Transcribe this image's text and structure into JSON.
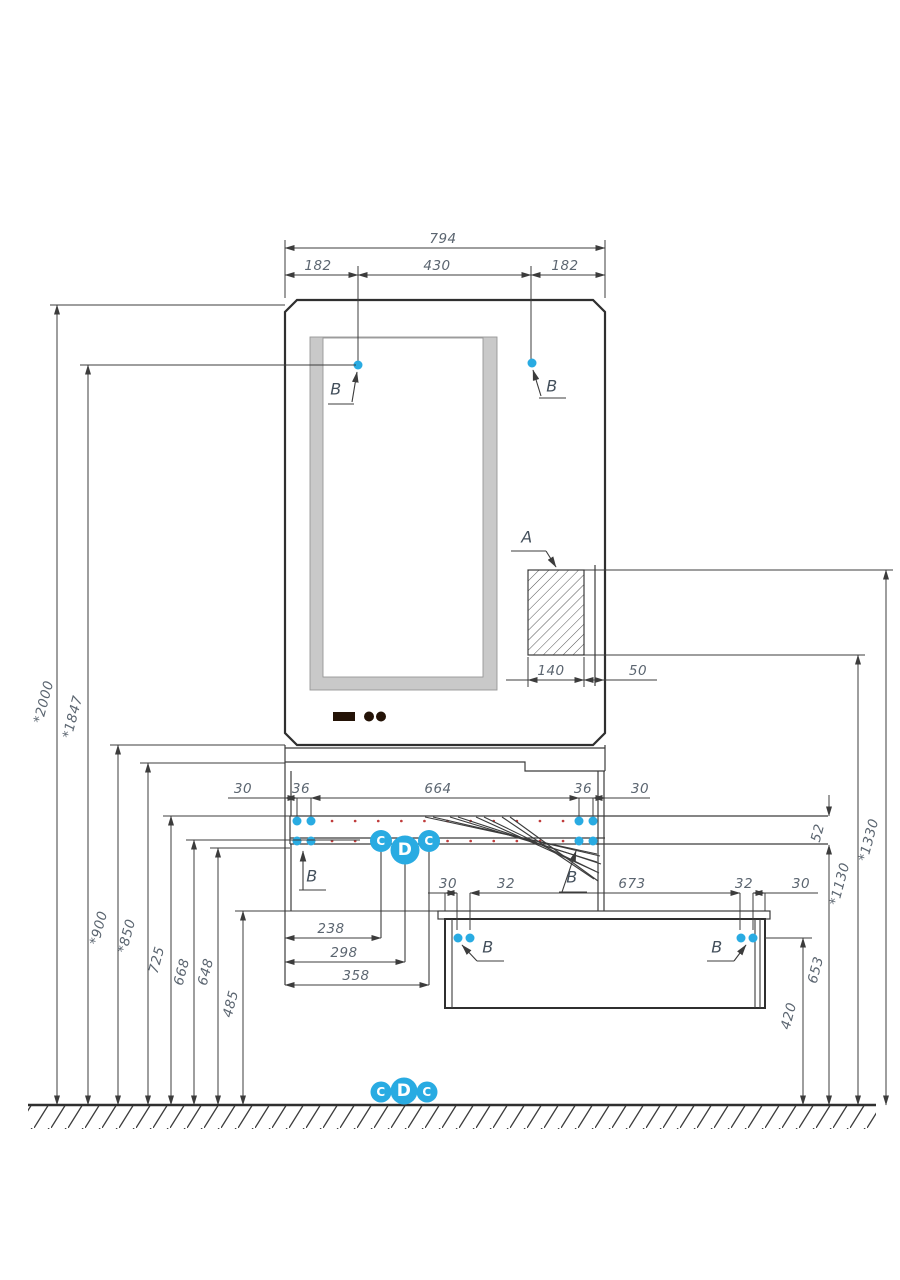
{
  "title": "furniture-installation-drawing",
  "colors": {
    "accent_blue": "#29abe2",
    "line": "#3c3c3c",
    "dim_text": "#5b6570",
    "red_dot": "#c03c3c",
    "mirror_gray": "#c9c9c9"
  },
  "callouts": {
    "a": "A",
    "b": "B",
    "c": "C",
    "d": "D"
  },
  "top_dims": {
    "overall": "794",
    "left": "182",
    "center": "430",
    "right": "182"
  },
  "section_dims": {
    "width": "140",
    "gap": "50"
  },
  "shelf_row": {
    "d1": "30",
    "d2": "36",
    "d3": "664",
    "d4": "36",
    "d5": "30"
  },
  "cabinet_row": {
    "d1": "30",
    "d2": "32",
    "d3": "673",
    "d4": "32",
    "d5": "30"
  },
  "offsets": {
    "d1": "238",
    "d2": "298",
    "d3": "358"
  },
  "left_heights": {
    "h1": "*2000",
    "h2": "*1847",
    "h3": "*900",
    "h4": "*850",
    "h5": "725",
    "h6": "668",
    "h7": "648",
    "h8": "485"
  },
  "right_heights": {
    "h1": "52",
    "h2": "*1330",
    "h3": "*1130",
    "h4": "653",
    "h5": "420"
  }
}
